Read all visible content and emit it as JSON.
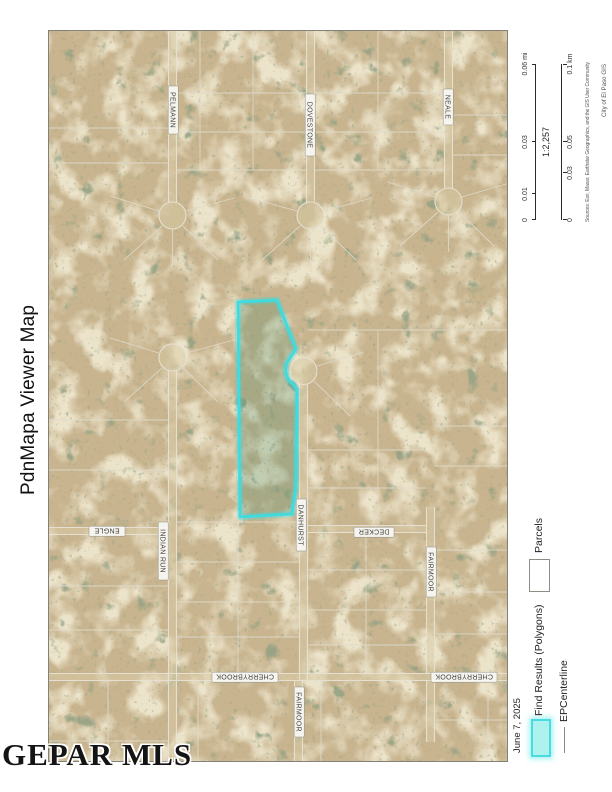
{
  "document": {
    "title": "PdnMapa Viewer Map",
    "date": "June 7, 2025",
    "watermark": "GEPAR MLS"
  },
  "scalebar": {
    "ratio": "1:2,257",
    "miles_ticks": [
      "0",
      "0.01",
      "0.03",
      "0.06 mi"
    ],
    "km_ticks": [
      "0",
      "0.03",
      "0.05",
      "0.1 km"
    ],
    "attribution": "Sources: Esri, Maxar, Earthstar Geographics, and the GIS User Community",
    "credit": "City of El Paso GIS"
  },
  "legend": {
    "find_results": {
      "label": "Find Results (Polygons)",
      "swatch_fill": "#aef2ef",
      "swatch_border": "#4adcdc"
    },
    "epcenterline": {
      "label": "EPCenterline",
      "line_color": "#8a8a8a"
    },
    "parcels": {
      "label": "Parcels",
      "swatch_fill": "#ffffff",
      "swatch_border": "#8d8d85"
    }
  },
  "map": {
    "highlight_outline": "#3edce0",
    "streets": {
      "pelmann": "PELMANN",
      "dovestone": "DOVESTONE",
      "neale": "NEALE",
      "indian_run": "INDIAN RUN",
      "engle": "ENGLE",
      "danhurst": "DANHURST",
      "decker": "DECKER",
      "fairmoor": "FAIRMOOR",
      "cherrybrook": "CHERRYBROOK"
    }
  }
}
